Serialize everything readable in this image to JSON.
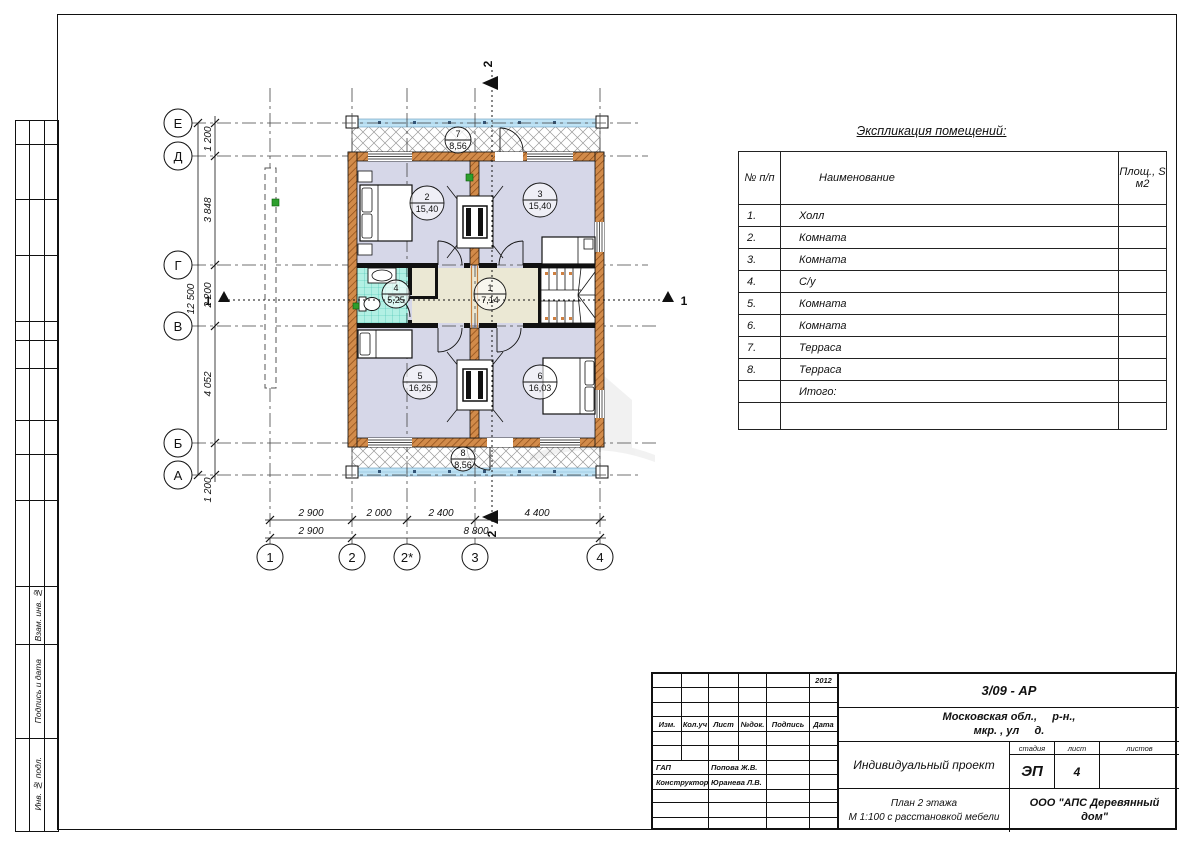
{
  "sheet": {
    "side_labels": [
      "Взам. инв. №",
      "Подпись и дата",
      "Инв. № подл."
    ]
  },
  "plan": {
    "axis_rows": [
      "Е",
      "Д",
      "Г",
      "В",
      "Б",
      "А"
    ],
    "axis_cols": [
      "1",
      "2",
      "2*",
      "3",
      "4"
    ],
    "dims_left": [
      "1 200",
      "3 848",
      "2 200",
      "4 052",
      "1 200"
    ],
    "dim_left_total": "12 500",
    "dims_bottom_upper": [
      "2 900",
      "2 000",
      "2 400",
      "4 400"
    ],
    "dims_bottom_lower": [
      "2 900",
      "8 800"
    ],
    "section_marker_1": "1",
    "section_marker_2": "2",
    "rooms": [
      {
        "num": "1",
        "area": "7,14"
      },
      {
        "num": "2",
        "area": "15,40"
      },
      {
        "num": "3",
        "area": "15,40"
      },
      {
        "num": "4",
        "area": "5,25"
      },
      {
        "num": "5",
        "area": "16,26"
      },
      {
        "num": "6",
        "area": "16,03"
      },
      {
        "num": "7",
        "area": "8,56"
      },
      {
        "num": "8",
        "area": "8,56"
      }
    ]
  },
  "explication": {
    "title": "Экспликация помещений:",
    "headers": {
      "num": "№ п/п",
      "name": "Наименование",
      "area": "Площ., S м2"
    },
    "rows": [
      {
        "num": "1.",
        "name": "Холл",
        "area": ""
      },
      {
        "num": "2.",
        "name": "Комната",
        "area": ""
      },
      {
        "num": "3.",
        "name": "Комната",
        "area": ""
      },
      {
        "num": "4.",
        "name": "С/у",
        "area": ""
      },
      {
        "num": "5.",
        "name": "Комната",
        "area": ""
      },
      {
        "num": "6.",
        "name": "Комната",
        "area": ""
      },
      {
        "num": "7.",
        "name": "Терраса",
        "area": ""
      },
      {
        "num": "8.",
        "name": "Терраса",
        "area": ""
      },
      {
        "num": "",
        "name": "Итого:",
        "area": ""
      },
      {
        "num": "",
        "name": "",
        "area": ""
      }
    ]
  },
  "title_block": {
    "year": "2012",
    "doc_code": "3/09 - АР",
    "address_line1": "Московская обл.,     р-н.,",
    "address_line2": "мкр. , ул     д.",
    "cols": [
      "Изм.",
      "Кол.уч",
      "Лист",
      "№док.",
      "Подпись",
      "Дата"
    ],
    "roles": [
      {
        "role": "ГАП",
        "name": "Попова Ж.В."
      },
      {
        "role": "Конструктор",
        "name": "Юранева Л.В."
      }
    ],
    "project": "Индивидуальный проект",
    "stage_label": "стадия",
    "sheet_label": "лист",
    "sheets_label": "листов",
    "stage": "ЭП",
    "sheet_no": "4",
    "sheets_total": "",
    "drawing_title_line1": "План 2 этажа",
    "drawing_title_line2": "М 1:100 с расстановкой мебели",
    "organization": "ООО \"АПС Деревянный дом\""
  }
}
